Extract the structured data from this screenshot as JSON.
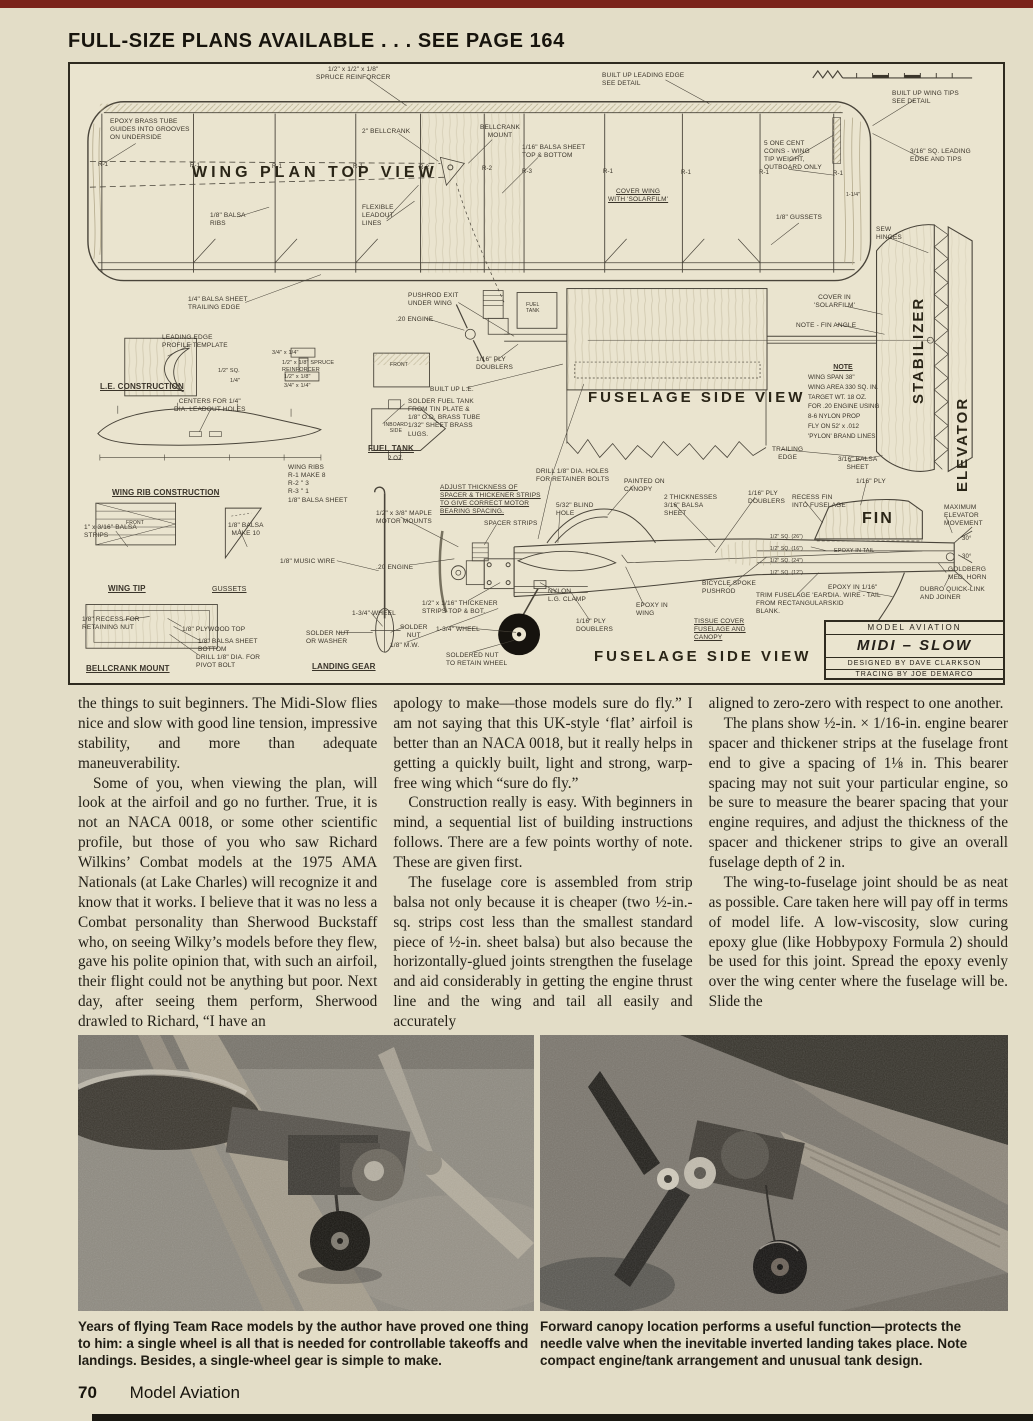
{
  "page": {
    "header": "FULL-SIZE PLANS AVAILABLE . . . SEE PAGE 164",
    "footer": {
      "page_number": "70",
      "magazine": "Model Aviation"
    }
  },
  "colors": {
    "page_bg": "#e3ddc7",
    "plan_bg": "#eae4cf",
    "top_strip": "#7b231a",
    "ink": "#221f17"
  },
  "plan": {
    "big_labels": {
      "wing_plan": "WING PLAN TOP VIEW",
      "fuselage_upper": "FUSELAGE SIDE VIEW",
      "fuselage_lower": "FUSELAGE SIDE VIEW",
      "stabilizer": "STABILIZER",
      "elevator": "ELEVATOR",
      "fin": "FIN"
    },
    "note": {
      "title": "NOTE",
      "body": "WING SPAN 38\"\nWING AREA 330 SQ. IN.\nTARGET WT. 18 OZ.\nFOR .20 ENGINE USING\n8-6 NYLON PROP\nFLY ON 52' x .012\n'PYLON' BRAND LINES"
    },
    "title_block": {
      "magazine": "MODEL AVIATION",
      "model": "MIDI – SLOW",
      "designer": "DESIGNED BY DAVE CLARKSON",
      "tracer": "TRACING BY JOE DEMARCO"
    },
    "labels": [
      {
        "t": "1/2\" x 1/2\" x 1/8\"\nSPRUCE REINFORCER",
        "x": 246,
        "y": 2,
        "c": 1
      },
      {
        "t": "BUILT UP LEADING EDGE\nSEE DETAIL",
        "x": 532,
        "y": 8
      },
      {
        "t": "BUILT UP WING TIPS\nSEE DETAIL",
        "x": 822,
        "y": 26
      },
      {
        "t": "EPOXY BRASS TUBE\nGUIDES INTO GROOVES\nON UNDERSIDE",
        "x": 40,
        "y": 54
      },
      {
        "t": "2\" BELLCRANK",
        "x": 292,
        "y": 64
      },
      {
        "t": "BELLCRANK\nMOUNT",
        "x": 410,
        "y": 60,
        "c": 1
      },
      {
        "t": "1/16\" BALSA SHEET\nTOP & BOTTOM",
        "x": 452,
        "y": 80
      },
      {
        "t": "5 ONE CENT\nCOINS - WING\nTIP WEIGHT,\nOUTBOARD ONLY",
        "x": 694,
        "y": 76
      },
      {
        "t": "3/16\" SQ. LEADING\nEDGE AND TIPS",
        "x": 840,
        "y": 84
      },
      {
        "t": "1-1/4\"",
        "x": 776,
        "y": 128,
        "s": 5
      },
      {
        "t": "1/8\" BALSA\nRIBS",
        "x": 140,
        "y": 148
      },
      {
        "t": "FLEXIBLE\nLEADOUT\nLINES",
        "x": 292,
        "y": 140
      },
      {
        "t": "COVER WING\nWITH 'SOLARFILM'",
        "x": 538,
        "y": 124,
        "u": 1,
        "c": 1
      },
      {
        "t": "1/8\" GUSSETS",
        "x": 706,
        "y": 150
      },
      {
        "t": "SEW\nHINGES",
        "x": 806,
        "y": 162
      },
      {
        "t": "1/4\" BALSA SHEET\nTRAILING EDGE",
        "x": 118,
        "y": 232
      },
      {
        "t": "PUSHROD EXIT\nUNDER WING",
        "x": 338,
        "y": 228
      },
      {
        "t": ".20 ENGINE",
        "x": 326,
        "y": 252
      },
      {
        "t": "FUEL\nTANK",
        "x": 456,
        "y": 238,
        "s": 5,
        "c": 1
      },
      {
        "t": "COVER IN\n'SOLARFILM'",
        "x": 744,
        "y": 230,
        "c": 1
      },
      {
        "t": "NOTE - FIN ANGLE",
        "x": 726,
        "y": 258
      },
      {
        "t": "LEADING EDGE\nPROFILE TEMPLATE",
        "x": 92,
        "y": 270
      },
      {
        "t": "L.E. CONSTRUCTION",
        "x": 30,
        "y": 318,
        "b": 1,
        "u": 1,
        "s": 8
      },
      {
        "t": "3/4\" x 1/4\"",
        "x": 202,
        "y": 286,
        "s": 5.5
      },
      {
        "t": "1/2\" x 1/8\" SPRUCE\nREINFORCER",
        "x": 212,
        "y": 296,
        "s": 5.5
      },
      {
        "t": "1/2\" SQ.",
        "x": 148,
        "y": 304,
        "s": 5.5
      },
      {
        "t": "1/4\"",
        "x": 160,
        "y": 314,
        "s": 5.5
      },
      {
        "t": "1/2\" x 1/8\"",
        "x": 214,
        "y": 310,
        "s": 5.5
      },
      {
        "t": "3/4\" x 1/4\"",
        "x": 214,
        "y": 319,
        "s": 5.5
      },
      {
        "t": "1/16\" PLY\nDOUBLERS",
        "x": 406,
        "y": 292
      },
      {
        "t": "BUILT UP L.E.",
        "x": 360,
        "y": 322
      },
      {
        "t": "CENTERS FOR 1/4\"\nDIA. LEADOUT HOLES",
        "x": 104,
        "y": 334,
        "c": 1
      },
      {
        "t": "SOLDER FUEL TANK\nFROM TIN PLATE &\n1/8\" O.D. BRASS TUBE\n1/32\" SHEET BRASS\nLUGS.",
        "x": 338,
        "y": 334
      },
      {
        "t": "FRONT",
        "x": 320,
        "y": 298,
        "s": 5
      },
      {
        "t": "INBOARD\nSIDE",
        "x": 314,
        "y": 358,
        "s": 5,
        "c": 1
      },
      {
        "t": "TRAILING\nEDGE",
        "x": 702,
        "y": 382,
        "c": 1
      },
      {
        "t": "3/16\" BALSA\nSHEET",
        "x": 768,
        "y": 392,
        "c": 1
      },
      {
        "t": "FUEL TANK",
        "x": 298,
        "y": 380,
        "b": 1,
        "u": 1,
        "s": 8
      },
      {
        "t": "2 OZ.",
        "x": 318,
        "y": 392,
        "s": 6
      },
      {
        "t": "WING RIB CONSTRUCTION",
        "x": 42,
        "y": 424,
        "b": 1,
        "u": 1,
        "s": 8
      },
      {
        "t": "WING RIBS\nR-1  MAKE 8\nR-2    \"    3\nR-3    \"    1\n1/8\" BALSA SHEET",
        "x": 218,
        "y": 400
      },
      {
        "t": "DRILL 1/8\" DIA. HOLES\nFOR RETAINER BOLTS",
        "x": 466,
        "y": 404
      },
      {
        "t": "ADJUST THICKNESS OF\nSPACER & THICKENER STRIPS\nTO GIVE CORRECT MOTOR\nBEARING SPACING.",
        "x": 370,
        "y": 420,
        "u": 1
      },
      {
        "t": "PAINTED ON\nCANOPY",
        "x": 554,
        "y": 414
      },
      {
        "t": "2 THICKNESSES\n3/16\" BALSA\nSHEET",
        "x": 594,
        "y": 430
      },
      {
        "t": "1/16\" PLY\nDOUBLERS",
        "x": 678,
        "y": 426
      },
      {
        "t": "RECESS FIN\nINTO FUSELAGE",
        "x": 722,
        "y": 430
      },
      {
        "t": "1/16\" PLY",
        "x": 786,
        "y": 414
      },
      {
        "t": "MAXIMUM\nELEVATOR\nMOVEMENT",
        "x": 874,
        "y": 440
      },
      {
        "t": "30°",
        "x": 892,
        "y": 472,
        "s": 6
      },
      {
        "t": "30°",
        "x": 892,
        "y": 490,
        "s": 6
      },
      {
        "t": "1\" x 3/16\" BALSA\nSTRIPS",
        "x": 14,
        "y": 460
      },
      {
        "t": "1/8\" BALSA\nMAKE 10",
        "x": 158,
        "y": 458,
        "c": 1
      },
      {
        "t": "1/2\" x 3/8\" MAPLE\nMOTOR MOUNTS",
        "x": 306,
        "y": 446
      },
      {
        "t": "SPACER STRIPS",
        "x": 414,
        "y": 456
      },
      {
        "t": "5/32\" BLIND\nHOLE",
        "x": 486,
        "y": 438
      },
      {
        "t": "1/8\" MUSIC WIRE",
        "x": 210,
        "y": 494
      },
      {
        "t": ".20 ENGINE",
        "x": 306,
        "y": 500
      },
      {
        "t": "WING TIP",
        "x": 38,
        "y": 520,
        "b": 1,
        "u": 1,
        "s": 8
      },
      {
        "t": "GUSSETS",
        "x": 142,
        "y": 522,
        "u": 1,
        "s": 7
      },
      {
        "t": "FRONT",
        "x": 56,
        "y": 456,
        "s": 5
      },
      {
        "t": "1/2\" SQ. (26\")",
        "x": 700,
        "y": 470,
        "s": 5
      },
      {
        "t": "1/2\" SQ. (16\")",
        "x": 700,
        "y": 482,
        "s": 5
      },
      {
        "t": "1/2\" SQ. (24\")",
        "x": 700,
        "y": 494,
        "s": 5
      },
      {
        "t": "1/2\" SQ. (12\")",
        "x": 700,
        "y": 506,
        "s": 5
      },
      {
        "t": "EPOXY IN TAIL",
        "x": 764,
        "y": 484,
        "s": 5.5
      },
      {
        "t": "GOLDBERG\nMED. HORN",
        "x": 878,
        "y": 502
      },
      {
        "t": "DUBRO QUICK-LINK\nAND JOINER",
        "x": 850,
        "y": 522
      },
      {
        "t": "TRIM FUSELAGE 'EAR'\nFROM RECTANGULAR\nBLANK.",
        "x": 686,
        "y": 528
      },
      {
        "t": "EPOXY IN 1/16\"\nDIA. WIRE - TAIL\nSKID",
        "x": 758,
        "y": 520
      },
      {
        "t": "NYLON\nL.G. CLAMP",
        "x": 478,
        "y": 524
      },
      {
        "t": "BICYCLE SPOKE\nPUSHROD",
        "x": 632,
        "y": 516
      },
      {
        "t": "1/2\" x 1/16\" THICKENER\nSTRIPS TOP & BOT.",
        "x": 352,
        "y": 536
      },
      {
        "t": "EPOXY IN\nWING",
        "x": 566,
        "y": 538
      },
      {
        "t": "1/16\" PLY\nDOUBLERS",
        "x": 506,
        "y": 554
      },
      {
        "t": "TISSUE COVER\nFUSELAGE AND\nCANOPY",
        "x": 624,
        "y": 554,
        "u": 1
      },
      {
        "t": "1-3/4\" WHEEL",
        "x": 282,
        "y": 546
      },
      {
        "t": "SOLDER\nNUT",
        "x": 330,
        "y": 560,
        "c": 1
      },
      {
        "t": "SOLDER NUT\nOR WASHER",
        "x": 236,
        "y": 566
      },
      {
        "t": "LANDING GEAR",
        "x": 242,
        "y": 598,
        "b": 1,
        "u": 1,
        "s": 8
      },
      {
        "t": "1/8\" RECESS FOR\nRETAINING NUT",
        "x": 12,
        "y": 552
      },
      {
        "t": "1/8\" PLYWOOD TOP",
        "x": 112,
        "y": 562
      },
      {
        "t": "1/8\" BALSA SHEET\nBOTTOM",
        "x": 128,
        "y": 574
      },
      {
        "t": "DRILL 1/8\" DIA. FOR\nPIVOT BOLT",
        "x": 126,
        "y": 590
      },
      {
        "t": "BELLCRANK MOUNT",
        "x": 16,
        "y": 600,
        "b": 1,
        "u": 1,
        "s": 8
      },
      {
        "t": "1-3/4\" WHEEL",
        "x": 366,
        "y": 562
      },
      {
        "t": "1/8\" M.W.",
        "x": 320,
        "y": 578
      },
      {
        "t": "SOLDERED NUT\nTO RETAIN WHEEL",
        "x": 376,
        "y": 588
      },
      {
        "t": "R-1",
        "x": 28,
        "y": 98,
        "s": 6
      },
      {
        "t": "R-1",
        "x": 120,
        "y": 99,
        "s": 6
      },
      {
        "t": "R-1",
        "x": 202,
        "y": 100,
        "s": 6
      },
      {
        "t": "R-1",
        "x": 283,
        "y": 100,
        "s": 6
      },
      {
        "t": "R-2",
        "x": 349,
        "y": 101,
        "s": 6
      },
      {
        "t": "R-2",
        "x": 412,
        "y": 102,
        "s": 6
      },
      {
        "t": "R-3",
        "x": 452,
        "y": 105,
        "s": 6
      },
      {
        "t": "R-1",
        "x": 533,
        "y": 105,
        "s": 6
      },
      {
        "t": "R-1",
        "x": 611,
        "y": 106,
        "s": 6
      },
      {
        "t": "R-1",
        "x": 689,
        "y": 106,
        "s": 6
      },
      {
        "t": "R-1",
        "x": 763,
        "y": 107,
        "s": 6
      }
    ]
  },
  "article": {
    "col1": [
      "the things to suit beginners. The Midi-Slow flies nice and slow with good line tension, impressive stability, and more than adequate maneuverability.",
      "Some of you, when viewing the plan, will look at the airfoil and go no further. True, it is not an NACA 0018, or some other scientific profile, but those of you who saw Richard Wilkins’ Combat models at the 1975 AMA Nationals (at Lake Charles) will recognize it and know that it works. I believe that it was no less a Combat personality than Sherwood Buckstaff who, on seeing Wilky’s models before they flew, gave his polite opinion that, with such an airfoil, their flight could not be anything but poor. Next day, after seeing them perform, Sherwood drawled to Richard, “I have an"
    ],
    "col2": [
      "apology to make—those models sure do fly.” I am not saying that this UK-style ‘flat’ airfoil is better than an NACA 0018, but it really helps in getting a quickly built, light and strong, warp-free wing which “sure do fly.”",
      "Construction really is easy. With beginners in mind, a sequential list of building instructions follows. There are a few points worthy of note. These are given first.",
      "The fuselage core is assembled from strip balsa not only because it is cheaper (two ½-in.-sq. strips cost less than the smallest standard piece of ½-in. sheet balsa) but also because the horizontally-glued joints strengthen the fuselage and aid considerably in getting the engine thrust line and the wing and tail all easily and accurately"
    ],
    "col3": [
      "aligned to zero-zero with respect to one another.",
      "The plans show ½-in. × 1/16-in. engine bearer spacer and thickener strips at the fuselage front end to give a spacing of 1⅛ in. This bearer spacing may not suit your particular engine, so be sure to measure the bearer spacing that your engine requires, and adjust the thickness of the spacer and thickener strips to give an overall fuselage depth of 2 in.",
      "The wing-to-fuselage joint should be as neat as possible. Care taken here will pay off in terms of model life. A low-viscosity, slow curing epoxy glue (like Hobbypoxy Formula 2) should be used for this joint. Spread the epoxy evenly over the wing center where the fuselage will be. Slide the"
    ]
  },
  "photos": {
    "left_caption": "Years of flying Team Race models by the author have proved one thing to him: a single wheel is all that is needed for controllable takeoffs and landings. Besides, a single-wheel gear is simple to make.",
    "right_caption": "Forward canopy location performs a useful function—protects the needle valve when the inevitable inverted landing takes place. Note compact engine/tank arrangement and unusual tank design."
  }
}
